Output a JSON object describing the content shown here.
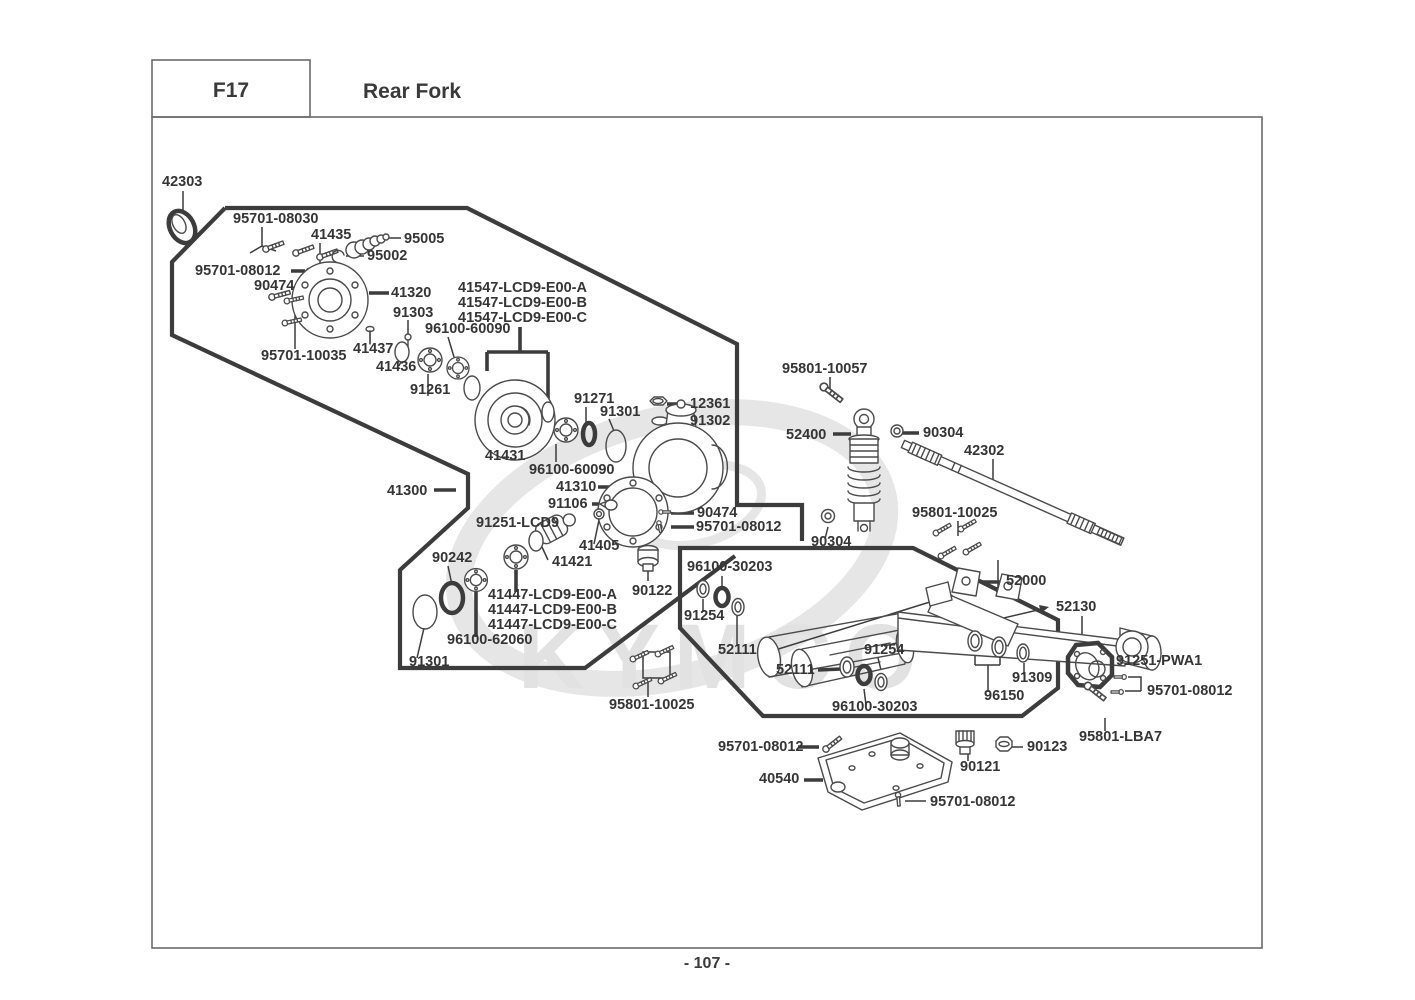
{
  "header": {
    "code": "F17",
    "title": "Rear Fork"
  },
  "page_number": "- 107 -",
  "watermark": "KYMCO",
  "diagram": {
    "labels": [
      {
        "text": "42303",
        "x": 162,
        "y": 186
      },
      {
        "text": "95701-08030",
        "x": 233,
        "y": 223
      },
      {
        "text": "41435",
        "x": 311,
        "y": 239
      },
      {
        "text": "95005",
        "x": 404,
        "y": 243
      },
      {
        "text": "95002",
        "x": 367,
        "y": 260
      },
      {
        "text": "95701-08012",
        "x": 195,
        "y": 275
      },
      {
        "text": "90474",
        "x": 254,
        "y": 290
      },
      {
        "text": "41320",
        "x": 391,
        "y": 297
      },
      {
        "text": "91303",
        "x": 393,
        "y": 317
      },
      {
        "text": "96100-60090",
        "x": 425,
        "y": 333
      },
      {
        "text": "95701-10035",
        "x": 261,
        "y": 360
      },
      {
        "text": "41437",
        "x": 353,
        "y": 353
      },
      {
        "text": "41436",
        "x": 376,
        "y": 371
      },
      {
        "text": "91261",
        "x": 410,
        "y": 394
      },
      {
        "text": "41547-LCD9-E00-A",
        "x": 458,
        "y": 292
      },
      {
        "text": "41547-LCD9-E00-B",
        "x": 458,
        "y": 307
      },
      {
        "text": "41547-LCD9-E00-C",
        "x": 458,
        "y": 322
      },
      {
        "text": "41431",
        "x": 485,
        "y": 460
      },
      {
        "text": "91271",
        "x": 574,
        "y": 403
      },
      {
        "text": "91301",
        "x": 600,
        "y": 416
      },
      {
        "text": "12361",
        "x": 690,
        "y": 408
      },
      {
        "text": "91302",
        "x": 690,
        "y": 425
      },
      {
        "text": "96100-60090",
        "x": 529,
        "y": 474
      },
      {
        "text": "41310",
        "x": 556,
        "y": 491
      },
      {
        "text": "91106",
        "x": 548,
        "y": 508
      },
      {
        "text": "90474",
        "x": 697,
        "y": 517
      },
      {
        "text": "95701-08012",
        "x": 696,
        "y": 531
      },
      {
        "text": "91251-LCD9",
        "x": 476,
        "y": 527
      },
      {
        "text": "41405",
        "x": 579,
        "y": 550
      },
      {
        "text": "41421",
        "x": 552,
        "y": 566
      },
      {
        "text": "90242",
        "x": 432,
        "y": 562
      },
      {
        "text": "41447-LCD9-E00-A",
        "x": 488,
        "y": 599
      },
      {
        "text": "41447-LCD9-E00-B",
        "x": 488,
        "y": 614
      },
      {
        "text": "41447-LCD9-E00-C",
        "x": 488,
        "y": 629
      },
      {
        "text": "96100-62060",
        "x": 447,
        "y": 644
      },
      {
        "text": "91301",
        "x": 409,
        "y": 666
      },
      {
        "text": "41300",
        "x": 387,
        "y": 495
      },
      {
        "text": "95801-10057",
        "x": 782,
        "y": 373
      },
      {
        "text": "52400",
        "x": 786,
        "y": 439
      },
      {
        "text": "90304",
        "x": 923,
        "y": 437
      },
      {
        "text": "42302",
        "x": 964,
        "y": 455
      },
      {
        "text": "95801-10025",
        "x": 912,
        "y": 517
      },
      {
        "text": "90304",
        "x": 811,
        "y": 546
      },
      {
        "text": "52000",
        "x": 1006,
        "y": 585
      },
      {
        "text": "52130",
        "x": 1056,
        "y": 611
      },
      {
        "text": "96100-30203",
        "x": 687,
        "y": 571
      },
      {
        "text": "90122",
        "x": 632,
        "y": 595
      },
      {
        "text": "91254",
        "x": 684,
        "y": 620
      },
      {
        "text": "52111",
        "x": 718,
        "y": 654
      },
      {
        "text": "52111",
        "x": 776,
        "y": 674
      },
      {
        "text": "91254",
        "x": 864,
        "y": 654
      },
      {
        "text": "95801-10025",
        "x": 609,
        "y": 709
      },
      {
        "text": "96100-30203",
        "x": 832,
        "y": 711
      },
      {
        "text": "96150",
        "x": 984,
        "y": 700
      },
      {
        "text": "91309",
        "x": 1012,
        "y": 682
      },
      {
        "text": "91251-PWA1",
        "x": 1116,
        "y": 665
      },
      {
        "text": "95701-08012",
        "x": 1147,
        "y": 695
      },
      {
        "text": "95801-LBA7",
        "x": 1079,
        "y": 741
      },
      {
        "text": "90123",
        "x": 1027,
        "y": 751
      },
      {
        "text": "90121",
        "x": 960,
        "y": 771
      },
      {
        "text": "95701-08012",
        "x": 718,
        "y": 751
      },
      {
        "text": "40540",
        "x": 759,
        "y": 783
      },
      {
        "text": "95701-08012",
        "x": 930,
        "y": 806
      }
    ]
  }
}
